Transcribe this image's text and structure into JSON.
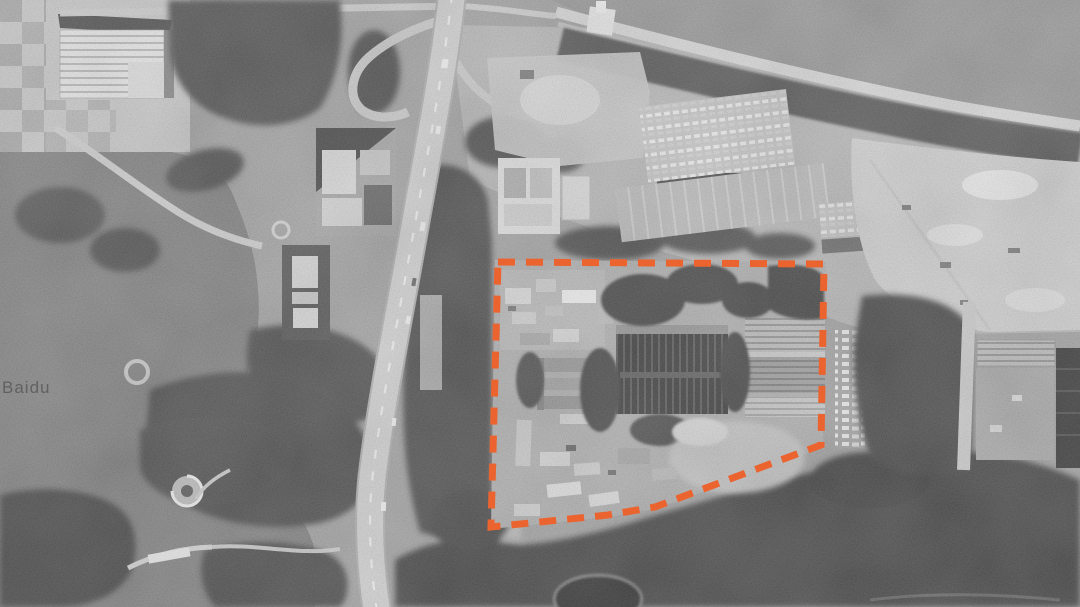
{
  "map": {
    "type": "grayscale-satellite-imagery",
    "watermark": "Baidu",
    "annotation": {
      "label": "site-boundary",
      "shape": "dashed-polygon",
      "color": "#EB6430",
      "points": "498,262 824,264 821,445 655,507 608,515 491,527",
      "dash_pattern": "17 11",
      "stroke_width": "7"
    }
  }
}
